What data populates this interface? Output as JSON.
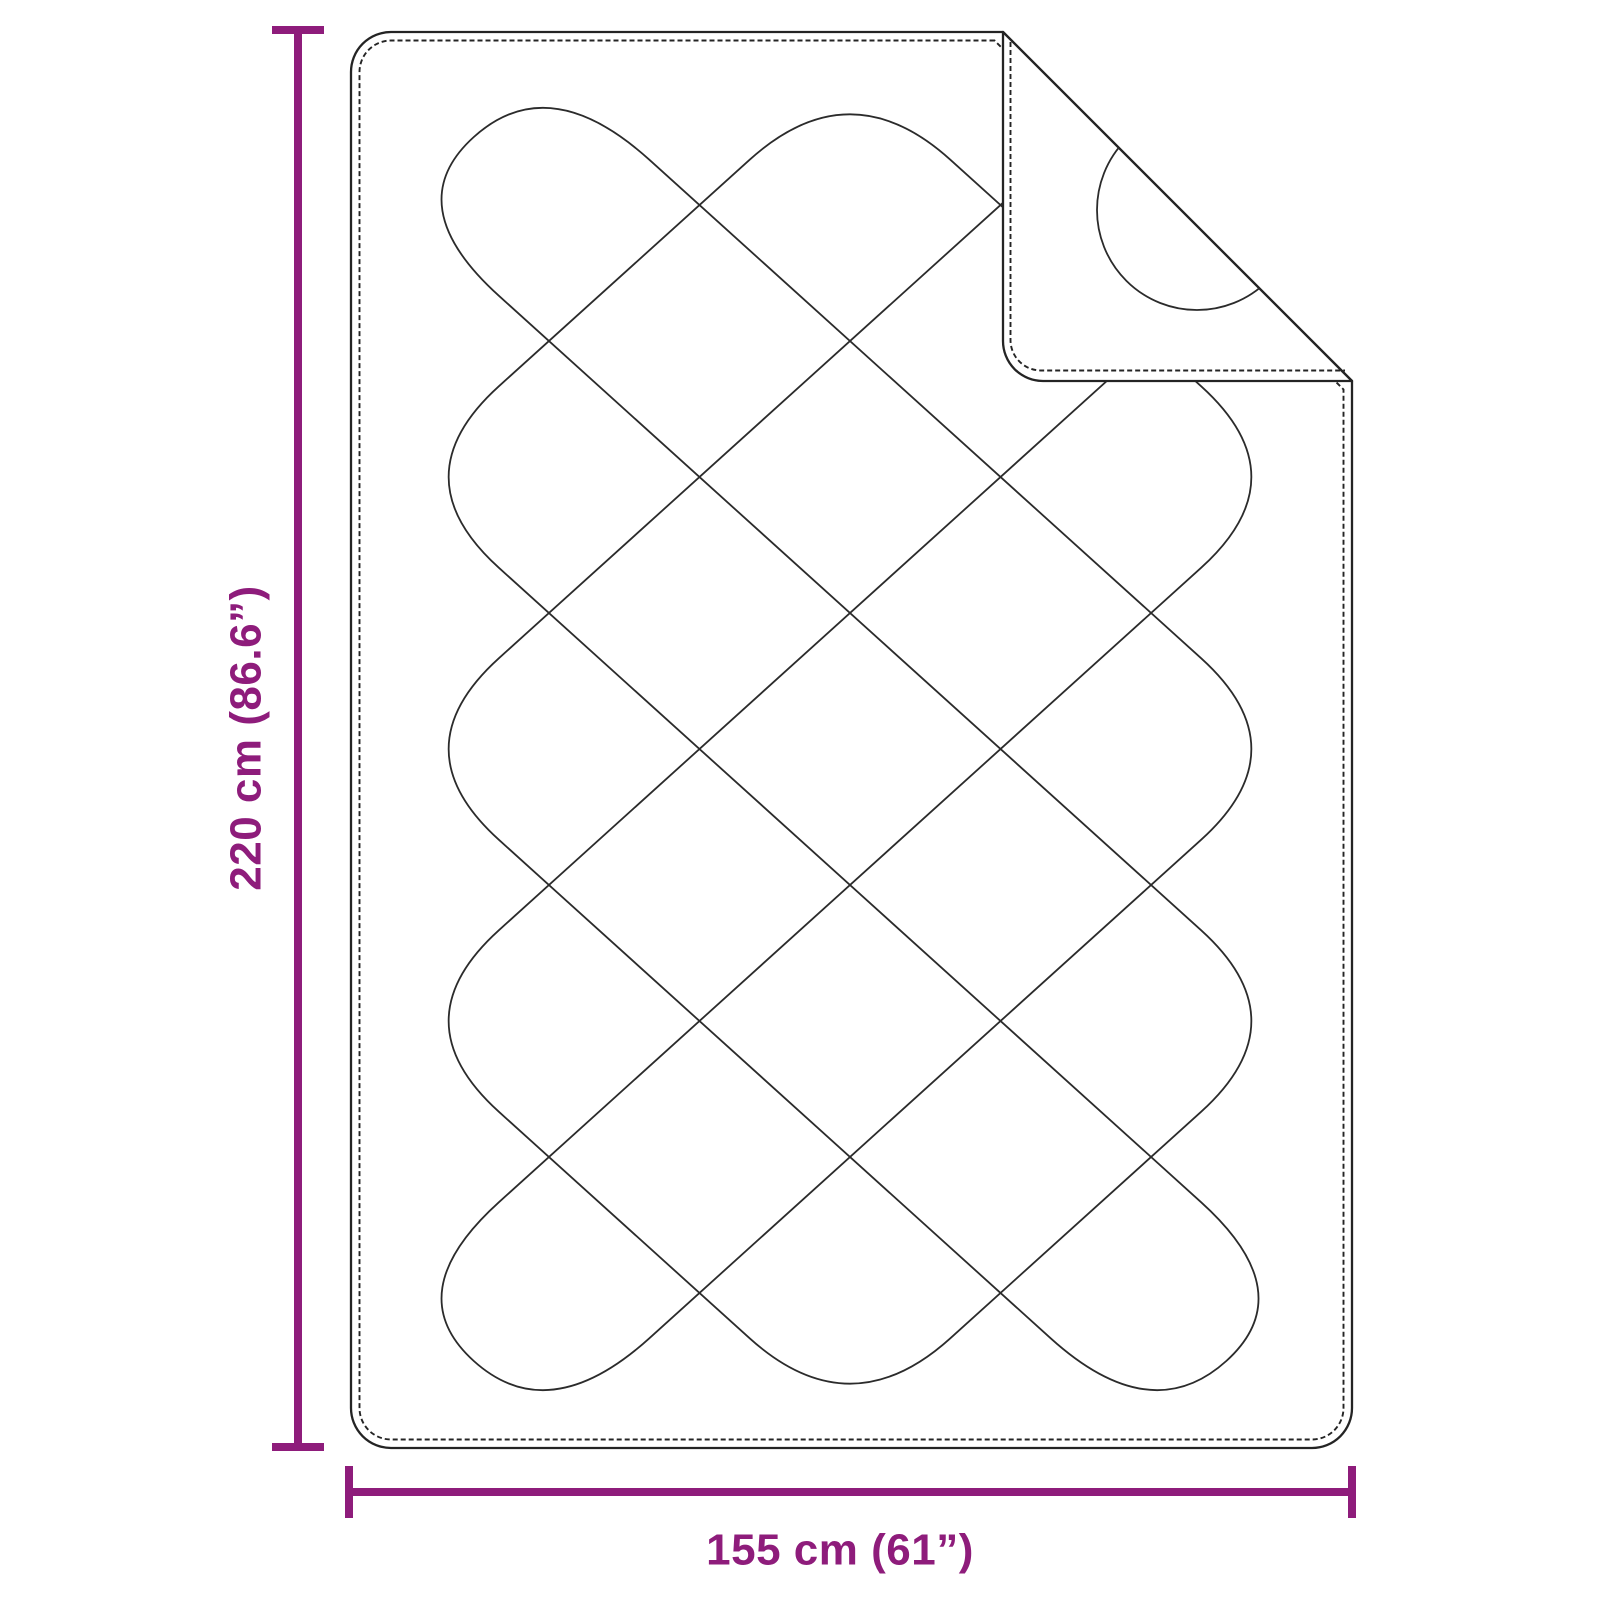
{
  "page": {
    "background": "#ffffff"
  },
  "diagram": {
    "type": "product-dimension-diagram",
    "subject": "quilted blanket with folded corner",
    "accent_color": "#8E1C7B",
    "line_color": "#242424",
    "height_dimension": {
      "label": "220 cm (86.6”)",
      "value_cm": 220,
      "value_in": 86.6
    },
    "width_dimension": {
      "label": "155 cm (61”)",
      "value_cm": 155,
      "value_in": 61
    },
    "quilt": {
      "x0": 398.5,
      "y0": 69,
      "hx": 150.5,
      "hy": 136,
      "nu": 6,
      "nv": 10,
      "pull": 0.6667
    }
  }
}
